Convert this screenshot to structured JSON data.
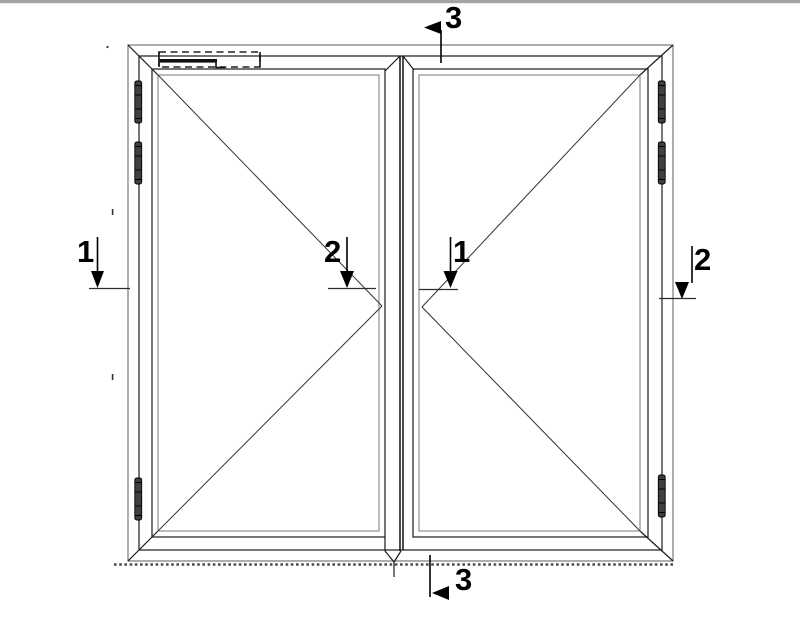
{
  "drawing": {
    "kind": "door-elevation-with-section-cuts",
    "section_markers": [
      {
        "label": "3",
        "position": "top"
      },
      {
        "label": "1",
        "position": "left"
      },
      {
        "label": "2",
        "position": "center-left"
      },
      {
        "label": "1",
        "position": "center-right"
      },
      {
        "label": "2",
        "position": "right"
      },
      {
        "label": "3",
        "position": "bottom"
      }
    ],
    "colors": {
      "background": "#ffffff",
      "line": "#1a1a1a",
      "light_line": "#7a7a7a",
      "top_bar": "#a3a3a3",
      "hinge_fill": "#3f3f3f",
      "text": "#000000"
    }
  }
}
